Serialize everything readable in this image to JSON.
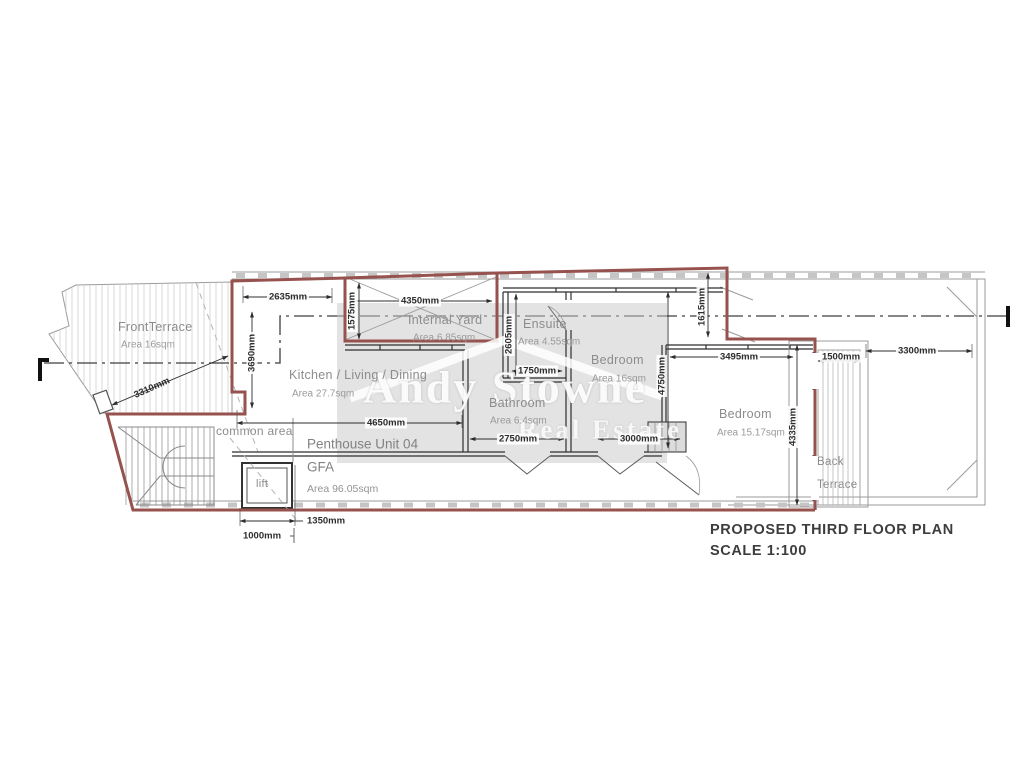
{
  "title_block": {
    "line1": "PROPOSED THIRD FLOOR PLAN",
    "line2": "SCALE 1:100"
  },
  "watermark": {
    "name": "Andy Stowne",
    "tagline": "Real Estate"
  },
  "unit": {
    "title": "Penthouse Unit 04",
    "gfa_label": "GFA",
    "gfa_area": "Area 96.05sqm"
  },
  "rooms": {
    "front_terrace": {
      "name": "FrontTerrace",
      "area": "Area 16sqm"
    },
    "kitchen": {
      "name": "Kitchen / Living / Dining",
      "area": "Area 27.7sqm"
    },
    "internal_yard": {
      "name": "Internal Yard",
      "area": "Area 6.85sqm"
    },
    "ensuite": {
      "name": "Ensuite",
      "area": "Area 4.55sqm"
    },
    "bedroom_1": {
      "name": "Bedroom",
      "area": "Area 16sqm"
    },
    "bathroom": {
      "name": "Bathroom",
      "area": "Area 6.4sqm"
    },
    "bedroom_2": {
      "name": "Bedroom",
      "area": "Area 15.17sqm"
    },
    "back_terrace": {
      "name": "Back Terrace"
    },
    "common_area": {
      "name": "common area"
    },
    "lift": {
      "name": "lift"
    }
  },
  "dims": {
    "front_terrace_diag": "3310mm",
    "kitchen_top": "2635mm",
    "kitchen_left": "3690mm",
    "yard_left": "1575mm",
    "yard_width": "4350mm",
    "ensuite_height": "2605mm",
    "ensuite_width": "1750mm",
    "kitchen_width": "4650mm",
    "bathroom_width": "2750mm",
    "bedroom1_width": "3000mm",
    "bedroom1_height": "4750mm",
    "bedroom1_right": "1615mm",
    "bedroom2_width": "3495mm",
    "back_terrace_width": "1500mm",
    "right_roof_width": "3300mm",
    "bedroom2_height": "4335mm",
    "lift_width": "1350mm",
    "lift_inner": "1000mm"
  },
  "colors": {
    "unit_boundary_red": "#96524e",
    "wall_black": "#2f2f2f",
    "outline_gray": "#9b9b9b",
    "room_text_gray": "#8c8c8c",
    "watermark_white": "#ffffff"
  }
}
